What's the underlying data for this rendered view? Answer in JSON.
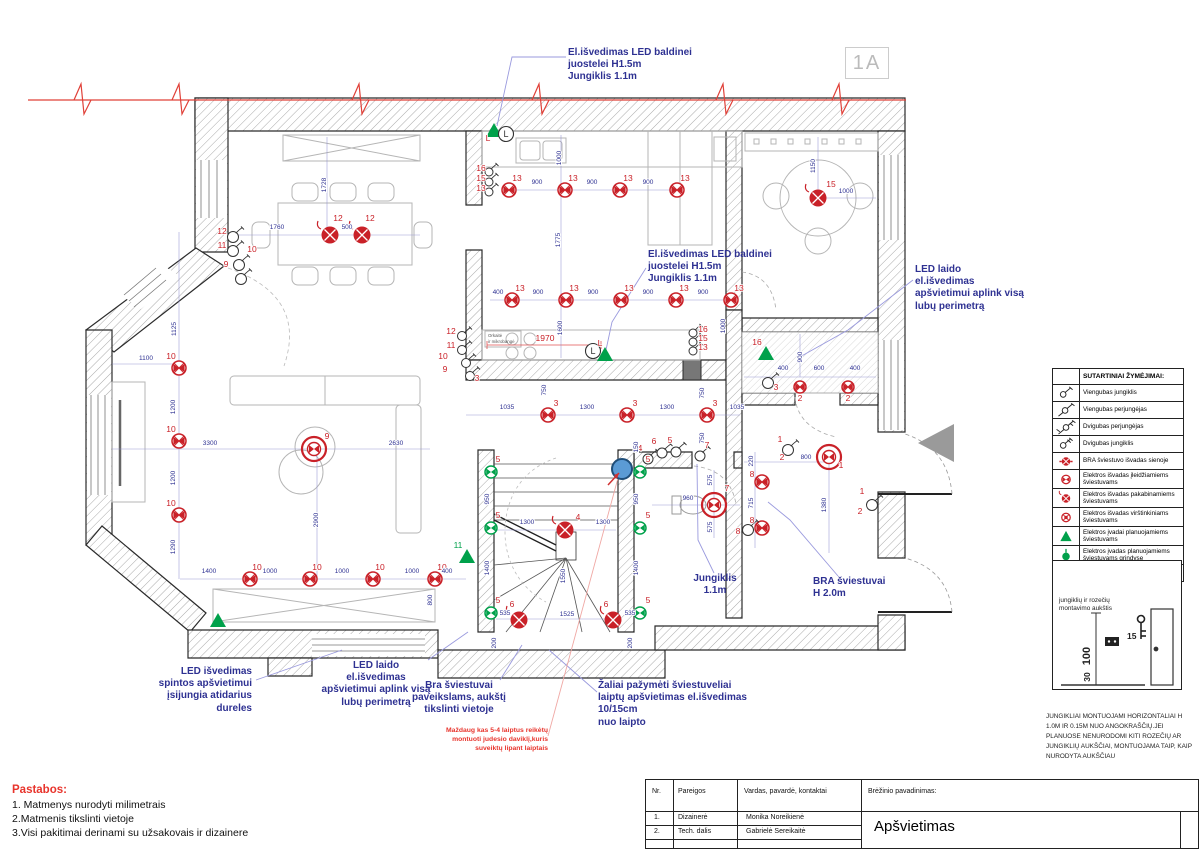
{
  "sheet": {
    "marker": "1A"
  },
  "notes": {
    "title": "Pastabos:",
    "items": [
      "1. Matmenys nurodyti milimetrais",
      "2.Matmenis tikslinti vietoje",
      "3.Visi pakitimai derinami su užsakovais ir dizainere"
    ]
  },
  "title_block": {
    "col_nr": "Nr.",
    "col_role": "Pareigos",
    "col_name": "Vardas, pavardė, kontaktai",
    "col_drawing": "Brėžinio pavadinimas:",
    "rows": [
      {
        "nr": "1.",
        "role": "Dizainerė",
        "name": "Monika Noreikienė"
      },
      {
        "nr": "2.",
        "role": "Tech. dalis",
        "name": "Gabrielė Sereikaitė"
      }
    ],
    "drawing_title": "Apšvietimas"
  },
  "legend": {
    "header": "SUTARTINIAI ŽYMĖJIMAI:",
    "items": [
      {
        "s": "sw1",
        "t": "Viengubas jungiklis"
      },
      {
        "s": "sw1p",
        "t": "Viengubas perjungėjas"
      },
      {
        "s": "sw2p",
        "t": "Dvigubas perjungėjas"
      },
      {
        "s": "sw2",
        "t": "Dvigubas jungiklis"
      },
      {
        "s": "bra",
        "t": "BRA šviestuvo išvadas sienoje"
      },
      {
        "s": "rec",
        "t": "Elektros išvadas įleidžiamiems šviestuvams"
      },
      {
        "s": "pend",
        "t": "Elektros išvadas pakabinamiems šviestuvams"
      },
      {
        "s": "surf",
        "t": "Elektros išvadas virštinkiniams šviestuvams"
      },
      {
        "s": "tri",
        "t": "Elektros įvadai planuojamiems šviestuvams"
      },
      {
        "s": "floor",
        "t": "Elektros įvadas planuojamiems šviestuvams grindyse"
      },
      {
        "s": "motion",
        "t": "Judesio daviklis"
      }
    ]
  },
  "mount": {
    "label": "jungiklių ir rozečių\nmontavimo aukštis",
    "d100": "100",
    "d30": "30",
    "d15": "15",
    "note": "JUNGIKLIAI MONTUOJAMI HORIZONTALIAI H 1.0M IR 0.15M NUO ANGOKRAŠČIŲ.JEI PLANUOSE NENURODOMI KITI ROZEČIŲ AR JUNGIKLIŲ AUKŠČIAI, MONTUOJAMA TAIP, KAIP NURODYTA AUKŠČIAU"
  },
  "colors": {
    "red": "#c92128",
    "green": "#00a14b",
    "blue": "#2e3192",
    "leader": "#9a9ade"
  },
  "annotations": [
    {
      "id": "led-strip-top",
      "x": 568,
      "y": 47,
      "w": 160,
      "a": "left",
      "c": "blue",
      "t": "El.išvedimas LED baldinei\njuostelei H1.5m\nJungiklis 1.1m"
    },
    {
      "id": "led-strip-mid",
      "x": 648,
      "y": 249,
      "w": 170,
      "a": "left",
      "c": "blue",
      "t": "El.išvedimas LED baldinei\njuostelei H1.5m\nJungiklis 1.1m"
    },
    {
      "id": "led-perimeter-right",
      "x": 915,
      "y": 264,
      "w": 115,
      "a": "left",
      "c": "blue",
      "t": "LED laido\nel.išvedimas\napšvietimui aplink visą\nlubų perimetrą"
    },
    {
      "id": "led-closet",
      "x": 100,
      "y": 666,
      "w": 152,
      "a": "right",
      "c": "blue",
      "t": "LED išvedimas\nspintos apšvietimui\nįsijungia atidarius\ndureles"
    },
    {
      "id": "led-perimeter-bottom",
      "x": 296,
      "y": 660,
      "w": 160,
      "a": "center",
      "c": "blue",
      "t": "LED laido\nel.išvedimas\napšvietimui aplink visą\nlubų perimetrą"
    },
    {
      "id": "bra-paintings",
      "x": 398,
      "y": 680,
      "w": 122,
      "a": "center",
      "c": "blue",
      "t": "Bra šviestuvai\npaveikslams, aukštį\ntikslinti vietoje"
    },
    {
      "id": "stair-lights",
      "x": 598,
      "y": 680,
      "w": 200,
      "a": "left",
      "c": "blue",
      "t": "Žaliai pažymėti šviestuveliai\nlaiptų apšvietimas el.išvedimas\n10/15cm\nnuo laipto"
    },
    {
      "id": "motion-note",
      "x": 418,
      "y": 726,
      "w": 130,
      "a": "right",
      "c": "red",
      "t": "Maždaug kas 5-4 laiptus reikėtų\nmontuoti judesio daviklį,kuris\nsuveiktų lipant laiptais"
    },
    {
      "id": "switch-height",
      "x": 683,
      "y": 573,
      "w": 64,
      "a": "center",
      "c": "blue",
      "t": "Jungiklis\n1.1m"
    },
    {
      "id": "bra-height",
      "x": 813,
      "y": 576,
      "w": 100,
      "a": "left",
      "c": "blue",
      "t": "BRA šviestuvai\nH 2.0m"
    }
  ],
  "plan": {
    "symbols": [
      [
        "rec",
        509,
        190
      ],
      [
        "rec",
        565,
        190
      ],
      [
        "rec",
        620,
        190
      ],
      [
        "rec",
        677,
        190
      ],
      [
        "rec",
        512,
        300
      ],
      [
        "rec",
        566,
        300
      ],
      [
        "rec",
        621,
        300
      ],
      [
        "rec",
        676,
        300
      ],
      [
        "rec",
        731,
        300
      ],
      [
        "rec",
        548,
        415
      ],
      [
        "rec",
        627,
        415
      ],
      [
        "rec",
        707,
        415
      ],
      [
        "rec",
        250,
        579
      ],
      [
        "rec",
        310,
        579
      ],
      [
        "rec",
        373,
        579
      ],
      [
        "rec",
        435,
        579
      ],
      [
        "rec",
        179,
        368
      ],
      [
        "rec",
        179,
        441
      ],
      [
        "rec",
        179,
        515
      ],
      [
        "rec",
        800,
        387,
        6
      ],
      [
        "rec",
        848,
        387,
        6
      ],
      [
        "rec",
        762,
        482
      ],
      [
        "rec",
        762,
        528
      ],
      [
        "chand",
        314,
        449
      ],
      [
        "chand",
        714,
        505
      ],
      [
        "chand",
        829,
        457
      ],
      [
        "pend",
        330,
        235
      ],
      [
        "pend",
        362,
        235
      ],
      [
        "pend",
        818,
        198
      ],
      [
        "pend",
        565,
        530
      ],
      [
        "pend",
        519,
        620
      ],
      [
        "pend",
        613,
        620
      ],
      [
        "green",
        491,
        472
      ],
      [
        "green",
        491,
        528
      ],
      [
        "green",
        491,
        613
      ],
      [
        "green",
        640,
        472
      ],
      [
        "green",
        640,
        528
      ],
      [
        "green",
        640,
        613
      ],
      [
        "tri",
        494,
        131
      ],
      [
        "tri",
        605,
        355
      ],
      [
        "tri",
        766,
        354
      ],
      [
        "tri",
        467,
        557
      ],
      [
        "tri",
        218,
        621
      ],
      [
        "gtri",
        934,
        443
      ],
      [
        "motion",
        622,
        469
      ],
      [
        "lcirc",
        506,
        134
      ],
      [
        "lcirc",
        593,
        351
      ],
      [
        "sw",
        233,
        237
      ],
      [
        "sw",
        233,
        251
      ],
      [
        "sw",
        239,
        265
      ],
      [
        "sw",
        241,
        279
      ],
      [
        "sw",
        489,
        172,
        4
      ],
      [
        "sw",
        489,
        182,
        4
      ],
      [
        "sw",
        489,
        192,
        4
      ],
      [
        "sw",
        462,
        336,
        4.5
      ],
      [
        "sw",
        462,
        350,
        4.5
      ],
      [
        "sw",
        466,
        363,
        4.5
      ],
      [
        "sw",
        470,
        376,
        4.5
      ],
      [
        "sw",
        693,
        333,
        4
      ],
      [
        "sw",
        693,
        342,
        4
      ],
      [
        "sw",
        693,
        351,
        4
      ],
      [
        "sw",
        788,
        450
      ],
      [
        "sw",
        872,
        505
      ],
      [
        "sw",
        768,
        383
      ],
      [
        "sw",
        748,
        530
      ],
      [
        "sw",
        648,
        459,
        5
      ],
      [
        "sw",
        662,
        453,
        5
      ],
      [
        "sw",
        676,
        452,
        5
      ],
      [
        "sw",
        700,
        456,
        5
      ]
    ],
    "light_labels": [
      [
        517,
        181,
        "13"
      ],
      [
        573,
        181,
        "13"
      ],
      [
        628,
        181,
        "13"
      ],
      [
        685,
        181,
        "13"
      ],
      [
        520,
        291,
        "13"
      ],
      [
        574,
        291,
        "13"
      ],
      [
        629,
        291,
        "13"
      ],
      [
        684,
        291,
        "13"
      ],
      [
        739,
        291,
        "13"
      ],
      [
        556,
        406,
        "3"
      ],
      [
        635,
        406,
        "3"
      ],
      [
        715,
        406,
        "3"
      ],
      [
        257,
        570,
        "10"
      ],
      [
        317,
        570,
        "10"
      ],
      [
        380,
        570,
        "10"
      ],
      [
        442,
        570,
        "10"
      ],
      [
        171,
        359,
        "10"
      ],
      [
        171,
        432,
        "10"
      ],
      [
        171,
        506,
        "10"
      ],
      [
        800,
        401,
        "2"
      ],
      [
        848,
        401,
        "2"
      ],
      [
        752,
        477,
        "8"
      ],
      [
        752,
        523,
        "8"
      ],
      [
        327,
        439,
        "9"
      ],
      [
        727,
        491,
        "7"
      ],
      [
        841,
        468,
        "1"
      ],
      [
        338,
        221,
        "12"
      ],
      [
        370,
        221,
        "12"
      ],
      [
        831,
        187,
        "15"
      ],
      [
        578,
        520,
        "4"
      ],
      [
        512,
        607,
        "6"
      ],
      [
        606,
        607,
        "6"
      ],
      [
        498,
        462,
        "5"
      ],
      [
        498,
        518,
        "5"
      ],
      [
        498,
        603,
        "5"
      ],
      [
        648,
        462,
        "5"
      ],
      [
        648,
        518,
        "5"
      ],
      [
        648,
        603,
        "5"
      ],
      [
        757,
        345,
        "16"
      ],
      [
        458,
        548,
        "11",
        1
      ],
      [
        222,
        234,
        "12"
      ],
      [
        222,
        248,
        "11"
      ],
      [
        252,
        252,
        "10"
      ],
      [
        226,
        267,
        "9"
      ],
      [
        481,
        171,
        "16"
      ],
      [
        481,
        181,
        "15"
      ],
      [
        481,
        191,
        "13"
      ],
      [
        451,
        334,
        "12"
      ],
      [
        451,
        348,
        "11"
      ],
      [
        443,
        359,
        "10"
      ],
      [
        445,
        372,
        "9"
      ],
      [
        477,
        381,
        "3"
      ],
      [
        703,
        332,
        "16"
      ],
      [
        703,
        341,
        "15"
      ],
      [
        703,
        350,
        "13"
      ],
      [
        780,
        442,
        "1"
      ],
      [
        782,
        460,
        "2"
      ],
      [
        862,
        494,
        "1"
      ],
      [
        860,
        514,
        "2"
      ],
      [
        776,
        390,
        "3"
      ],
      [
        738,
        534,
        "8"
      ],
      [
        640,
        451,
        "4"
      ],
      [
        654,
        444,
        "6"
      ],
      [
        670,
        443,
        "5"
      ],
      [
        707,
        448,
        "7"
      ],
      [
        488,
        141,
        "L"
      ],
      [
        600,
        346,
        "L"
      ],
      [
        545,
        341,
        "1970"
      ]
    ],
    "dims": [
      [
        537,
        184,
        "900"
      ],
      [
        592,
        184,
        "900"
      ],
      [
        648,
        184,
        "900"
      ],
      [
        498,
        294,
        "400"
      ],
      [
        538,
        294,
        "900"
      ],
      [
        593,
        294,
        "900"
      ],
      [
        648,
        294,
        "900"
      ],
      [
        703,
        294,
        "900"
      ],
      [
        507,
        409,
        "1035"
      ],
      [
        587,
        409,
        "1300"
      ],
      [
        667,
        409,
        "1300"
      ],
      [
        737,
        409,
        "1035"
      ],
      [
        546,
        390,
        "750",
        1
      ],
      [
        704,
        393,
        "750",
        1
      ],
      [
        704,
        438,
        "750",
        1
      ],
      [
        277,
        229,
        "1760"
      ],
      [
        347,
        229,
        "500"
      ],
      [
        326,
        185,
        "1728",
        1
      ],
      [
        176,
        329,
        "1125",
        1
      ],
      [
        146,
        360,
        "1100"
      ],
      [
        210,
        445,
        "3300"
      ],
      [
        396,
        445,
        "2630"
      ],
      [
        318,
        520,
        "2900",
        1
      ],
      [
        175,
        407,
        "1200",
        1
      ],
      [
        175,
        478,
        "1200",
        1
      ],
      [
        175,
        547,
        "1290",
        1
      ],
      [
        209,
        573,
        "1400"
      ],
      [
        270,
        573,
        "1000"
      ],
      [
        342,
        573,
        "1000"
      ],
      [
        412,
        573,
        "1000"
      ],
      [
        447,
        573,
        "400"
      ],
      [
        432,
        600,
        "800",
        1
      ],
      [
        561,
        158,
        "1000",
        1
      ],
      [
        560,
        240,
        "1775",
        1
      ],
      [
        562,
        328,
        "1600",
        1
      ],
      [
        725,
        326,
        "1000",
        1
      ],
      [
        815,
        166,
        "1150",
        1
      ],
      [
        846,
        193,
        "1000"
      ],
      [
        802,
        357,
        "900",
        1
      ],
      [
        783,
        370,
        "400"
      ],
      [
        819,
        370,
        "600"
      ],
      [
        855,
        370,
        "400"
      ],
      [
        806,
        459,
        "800"
      ],
      [
        826,
        505,
        "1380",
        1
      ],
      [
        688,
        500,
        "960"
      ],
      [
        712,
        480,
        "575",
        1
      ],
      [
        712,
        527,
        "575",
        1
      ],
      [
        753,
        461,
        "220",
        1
      ],
      [
        753,
        503,
        "715",
        1
      ],
      [
        527,
        524,
        "1300"
      ],
      [
        603,
        524,
        "1300"
      ],
      [
        489,
        499,
        "950",
        1
      ],
      [
        638,
        499,
        "950",
        1
      ],
      [
        489,
        568,
        "1400",
        1
      ],
      [
        638,
        568,
        "1400",
        1
      ],
      [
        565,
        576,
        "1550",
        1
      ],
      [
        567,
        616,
        "1525"
      ],
      [
        505,
        615,
        "535"
      ],
      [
        630,
        615,
        "535"
      ],
      [
        638,
        447,
        "150",
        1
      ],
      [
        496,
        643,
        "200",
        1
      ],
      [
        632,
        643,
        "200",
        1
      ]
    ],
    "dlines": [
      [
        509,
        190,
        677,
        190
      ],
      [
        490,
        300,
        731,
        300
      ],
      [
        466,
        415,
        740,
        415
      ],
      [
        180,
        579,
        466,
        579
      ],
      [
        179,
        232,
        179,
        579
      ],
      [
        232,
        235,
        420,
        235
      ],
      [
        327,
        137,
        327,
        232
      ],
      [
        112,
        449,
        430,
        449
      ],
      [
        317,
        449,
        317,
        577
      ],
      [
        818,
        137,
        818,
        196
      ],
      [
        820,
        198,
        876,
        198
      ],
      [
        744,
        377,
        876,
        377
      ],
      [
        800,
        334,
        800,
        377
      ],
      [
        744,
        462,
        827,
        462
      ],
      [
        829,
        464,
        829,
        553
      ],
      [
        652,
        505,
        740,
        505
      ],
      [
        714,
        470,
        714,
        538
      ],
      [
        755,
        452,
        755,
        548
      ],
      [
        496,
        530,
        616,
        530
      ],
      [
        496,
        619,
        616,
        619
      ],
      [
        561,
        135,
        561,
        358
      ],
      [
        112,
        364,
        179,
        364
      ]
    ],
    "leaders": [
      {
        "c": "b",
        "p": [
          [
            566,
            57
          ],
          [
            512,
            57
          ],
          [
            497,
            126
          ]
        ]
      },
      {
        "c": "b",
        "p": [
          [
            646,
            268
          ],
          [
            612,
            322
          ],
          [
            606,
            350
          ]
        ]
      },
      {
        "c": "b",
        "p": [
          [
            913,
            280
          ],
          [
            848,
            330
          ],
          [
            798,
            358
          ]
        ]
      },
      {
        "c": "b",
        "p": [
          [
            256,
            680
          ],
          [
            342,
            650
          ]
        ]
      },
      {
        "c": "b",
        "p": [
          [
            428,
            660
          ],
          [
            468,
            632
          ]
        ]
      },
      {
        "c": "b",
        "p": [
          [
            500,
            680
          ],
          [
            522,
            645
          ]
        ]
      },
      {
        "c": "b",
        "p": [
          [
            597,
            692
          ],
          [
            549,
            650
          ]
        ]
      },
      {
        "c": "b",
        "p": [
          [
            714,
            573
          ],
          [
            698,
            540
          ],
          [
            697,
            464
          ]
        ]
      },
      {
        "c": "b",
        "p": [
          [
            838,
            576
          ],
          [
            790,
            520
          ],
          [
            768,
            502
          ]
        ]
      },
      {
        "c": "r",
        "p": [
          [
            548,
            736
          ],
          [
            618,
            478
          ]
        ]
      }
    ],
    "texts": [
      [
        488,
        337,
        "Orkaitė"
      ],
      [
        488,
        343,
        "ir mikrobangė"
      ]
    ]
  }
}
